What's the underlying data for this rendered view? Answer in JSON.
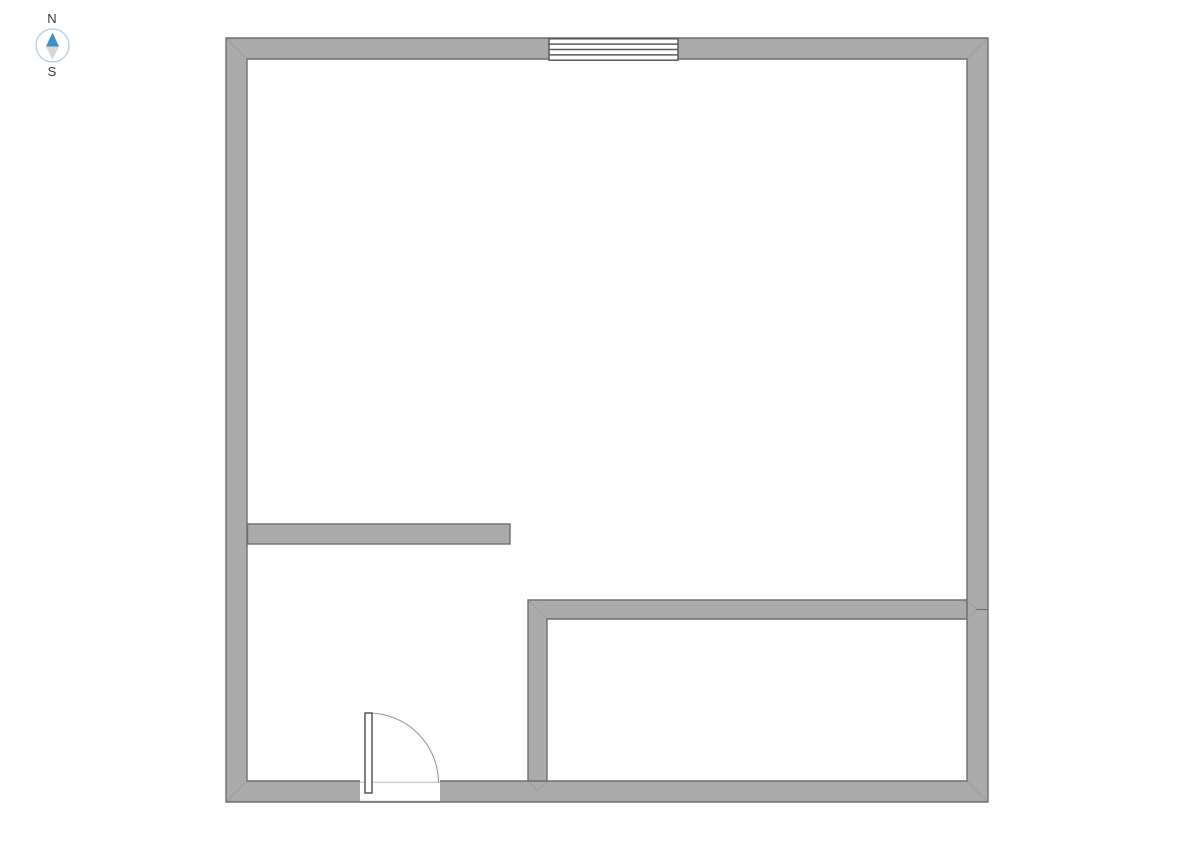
{
  "compass": {
    "north_label": "N",
    "south_label": "S"
  },
  "colors": {
    "canvas_bg": "#FFFFFF",
    "wall_fill": "#ABABAB",
    "wall_border": "#6E6E6E",
    "miter_line": "#8F8F8F",
    "window_fill": "#FFFFFF",
    "window_frame": "#5A5A5A",
    "door_fill": "#FFFFFF",
    "door_frame": "#4A4A4A",
    "door_arc": "#9A9A9A",
    "threshold_line": "#C6C6C6",
    "opening_fill": "#FFFFFF",
    "compass_ring": "#AECBDE",
    "compass_ring_fill": "#FFFFFF",
    "compass_north": "#4090C8",
    "compass_south": "#D6D6D6",
    "compass_text": "#3A3A3A"
  }
}
